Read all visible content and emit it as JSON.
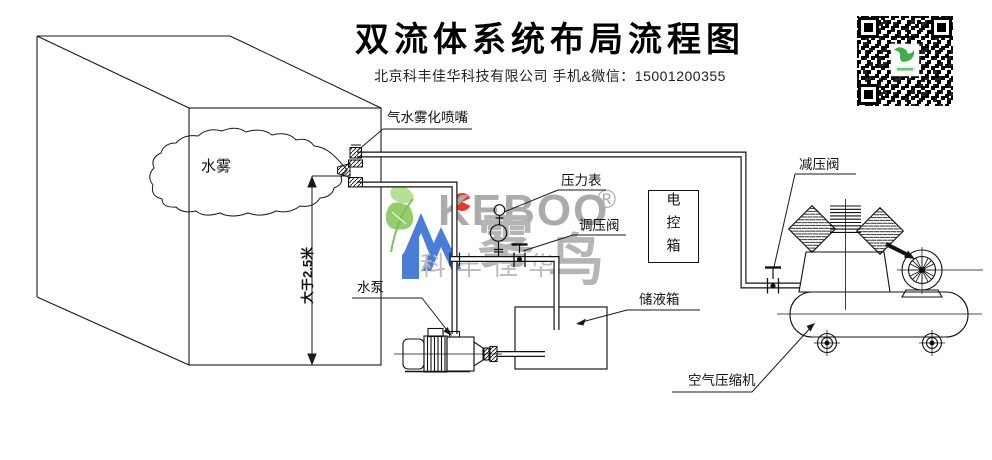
{
  "header": {
    "title": "双流体系统布局流程图",
    "subtitle": "北京科丰佳华科技有限公司 手机&微信：15001200355"
  },
  "labels": {
    "mist": "水雾",
    "min_height": "大于2.5米",
    "nozzle": "气水雾化喷嘴",
    "pressure_gauge": "压力表",
    "regulating_valve": "调压阀",
    "water_pump": "水泵",
    "liquid_tank": "储液箱",
    "control_box": "电控箱",
    "reducing_valve": "减压阀",
    "air_compressor": "空气压缩机"
  },
  "watermark": {
    "brand_en": "KEBOO",
    "registered": "®",
    "brand_cn_char1": "雾",
    "brand_cn_char2": "鸟",
    "company": "科丰佳华"
  },
  "colors": {
    "line": "#1a1a1a",
    "wm_gray": "#ababab",
    "wm_blue": "#4a7dd8",
    "wm_red": "#e7392b",
    "wm_green": "#8cc86e",
    "qr_green": "#3fae4a"
  }
}
